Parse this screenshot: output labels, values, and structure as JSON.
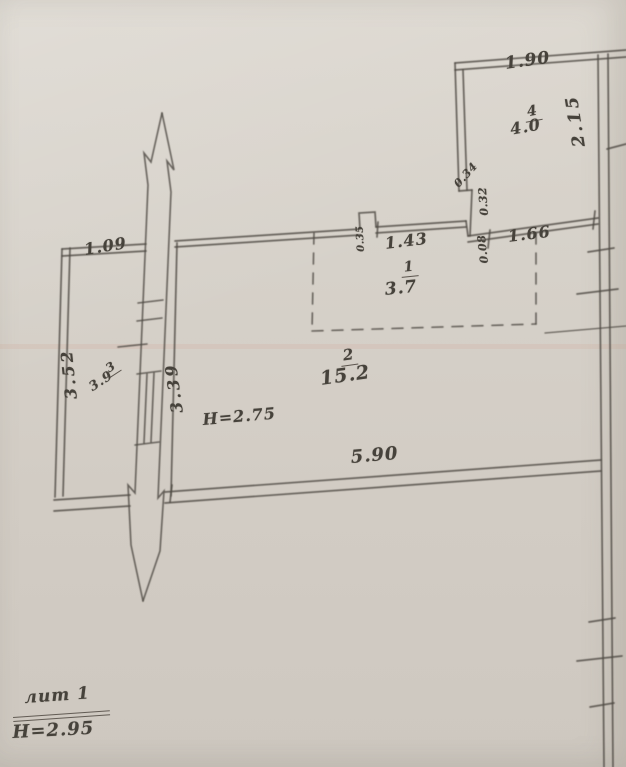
{
  "palette": {
    "paper": "#d5d0c8",
    "ink": "#4e4a43",
    "text": "#46423b"
  },
  "plan": {
    "rooms": [
      {
        "number": "1",
        "area": "3.7"
      },
      {
        "number": "2",
        "area": "15.2"
      },
      {
        "number": "3",
        "area": "3.9"
      },
      {
        "number": "4",
        "area": "4.0"
      }
    ],
    "height_note_main": "H=2.75",
    "dimensions": {
      "d190": "1.90",
      "d215": "2.15",
      "d034": "0.34",
      "d032": "0.32",
      "d035": "0.35",
      "d008": "0.08",
      "d143": "1.43",
      "d166": "1.66",
      "d109": "1.09",
      "d352": "3.52",
      "d339": "3.39",
      "d590": "5.90"
    },
    "footer": {
      "liter": "лит 1",
      "height": "H=2.95"
    }
  }
}
